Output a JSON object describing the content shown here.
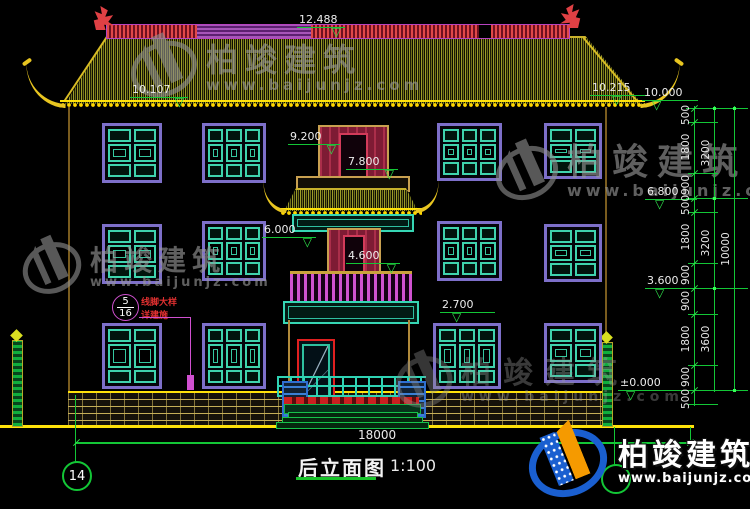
{
  "drawing": {
    "title": "后立面图",
    "scale": "1:100",
    "overall_width_dim": "18000",
    "grid_bubble_left": "14"
  },
  "levels": {
    "ridge": "12.488",
    "eave_left": "10.107",
    "eave_right": "10.215",
    "roof_right": "10.000",
    "tower_top": "9.200",
    "tower_door_top": "7.800",
    "floor3_line": "6.800",
    "tower_mid": "6.000",
    "tower_door_mid": "4.600",
    "floor2_line": "3.600",
    "window_top": "2.700",
    "ground": "±0.000"
  },
  "right_dims": {
    "col1": [
      "500",
      "1800",
      "900",
      "500",
      "1800",
      "900",
      "900",
      "1800",
      "900",
      "500"
    ],
    "col2": [
      "3200",
      "3200",
      "3600"
    ],
    "col3": [
      "10000"
    ]
  },
  "callout": {
    "detail_no": "5",
    "sheet_no": "16",
    "text1": "线脚大样",
    "text2": "详建施"
  },
  "watermark": {
    "brand": "柏竣建筑",
    "url": "www.baijunjz.com"
  },
  "colors": {
    "dim_green": "#13c636",
    "ridge_magenta": "#b743c0",
    "roof_yellow": "#e8c520",
    "window_teal": "#3fd3ad",
    "frame_purple": "#7d6fc9",
    "door_maroon": "#7e1b34",
    "logo_blue": "#1a5fd0",
    "logo_orange": "#f59a00"
  }
}
